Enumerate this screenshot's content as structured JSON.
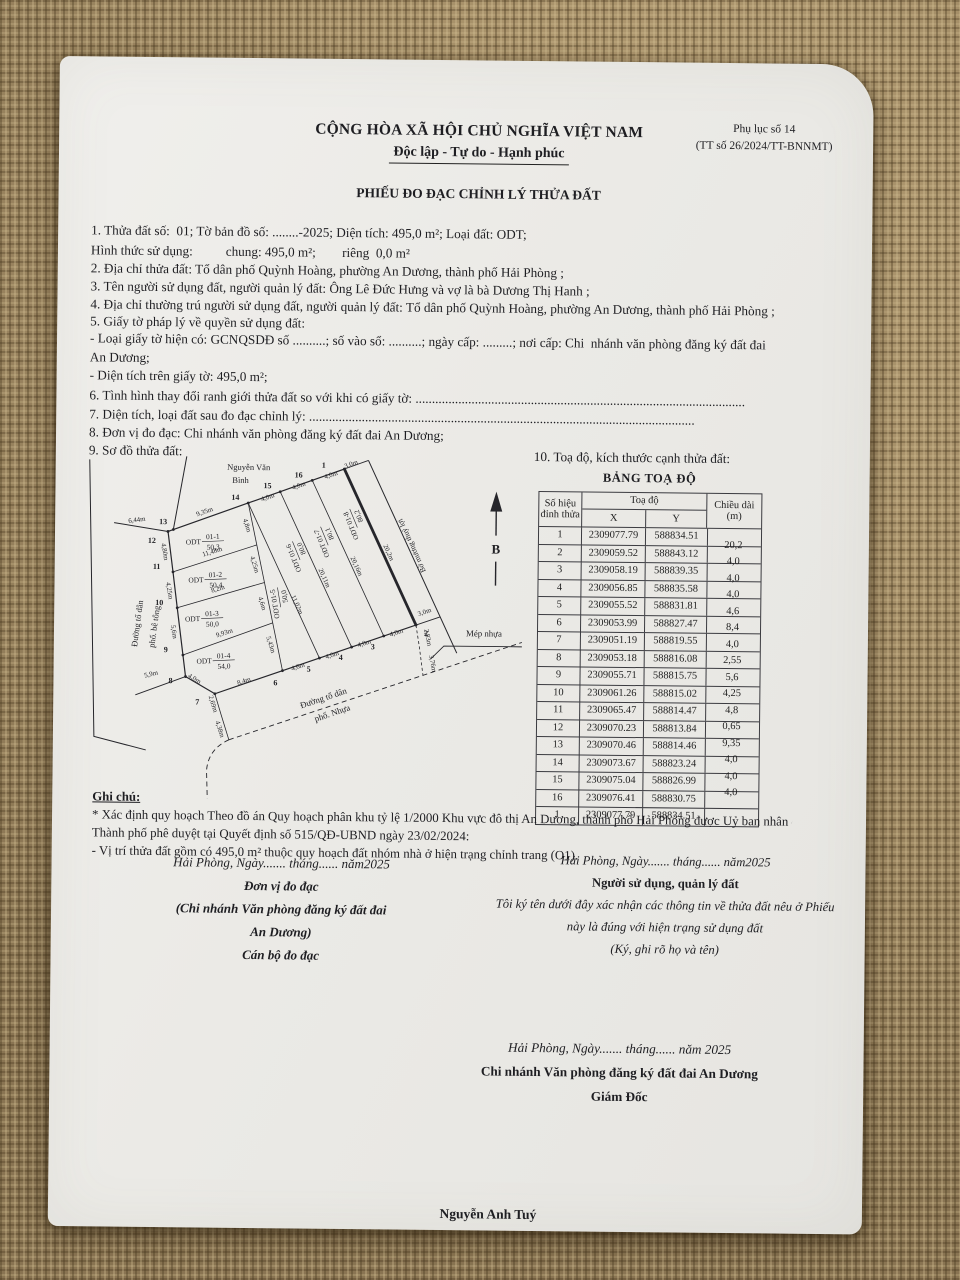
{
  "colors": {
    "fabric": "#a78e64",
    "paper": "#edece8",
    "ink": "#1e1e22"
  },
  "header": {
    "national_title": "CỘNG HÒA XÃ HỘI CHỦ NGHĨA VIỆT NAM",
    "motto": "Độc lập - Tự do - Hạnh phúc",
    "appendix1": "Phụ lục số 14",
    "appendix2": "(TT số 26/2024/TT-BNNMT)",
    "form_title": "PHIẾU ĐO ĐẠC CHỈNH LÝ THỬA ĐẤT"
  },
  "items": {
    "i1": "1. Thửa đất số:  01; Tờ bản đồ số: ........-2025; Diện tích: 495,0 m²; Loại đất: ODT;",
    "i1b": "Hình thức sử dụng:          chung: 495,0 m²;        riêng  0,0 m²",
    "i2": "2. Địa chỉ thửa đất: Tổ dân phố Quỳnh Hoàng, phường An Dương, thành phố Hải Phòng ;",
    "i3": "3. Tên người sử dụng đất, người quản lý đất: Ông Lê Đức Hưng và vợ là bà Dương Thị Hanh ;",
    "i4": "4. Địa chỉ thường trú người sử dụng đất, người quản lý đất: Tổ dân phố Quỳnh Hoàng, phường An Dương, thành phố Hải Phòng ;",
    "i5": "5. Giấy tờ pháp lý về quyền sử dụng đất:",
    "i5a": "- Loại giấy tờ hiện có: GCNQSDĐ số ..........; số vào sổ: ..........; ngày cấp: .........; nơi cấp: Chi  nhánh văn phòng đăng ký đất đai",
    "i5a2": "An Dương;",
    "i5b": "- Diện tích trên giấy tờ: 495,0 m²;",
    "i6": "6. Tình hình thay đổi ranh giới thửa đất so với khi có giấy tờ: ....................................................................................................",
    "i7": "7. Diện tích, loại đất sau đo đạc chỉnh lý: .....................................................................................................................",
    "i8": "8. Đơn vị đo đạc: Chi nhánh văn phòng đăng ký đất đai An Dương;",
    "i9": "9. Sơ đồ thửa đất:",
    "i10": "10. Toạ độ, kích thước cạnh thửa đất:"
  },
  "table": {
    "title": "BẢNG TOẠ ĐỘ",
    "col_vertex1": "Số hiệu",
    "col_vertex2": "đỉnh thửa",
    "col_coord": "Toạ độ",
    "col_x": "X",
    "col_y": "Y",
    "col_len1": "Chiều dài",
    "col_len2": "(m)",
    "rows": [
      {
        "v": "1",
        "x": "2309077.79",
        "y": "588834.51"
      },
      {
        "v": "2",
        "x": "2309059.52",
        "y": "588843.12"
      },
      {
        "v": "3",
        "x": "2309058.19",
        "y": "588839.35"
      },
      {
        "v": "4",
        "x": "2309056.85",
        "y": "588835.58"
      },
      {
        "v": "5",
        "x": "2309055.52",
        "y": "588831.81"
      },
      {
        "v": "6",
        "x": "2309053.99",
        "y": "588827.47"
      },
      {
        "v": "7",
        "x": "2309051.19",
        "y": "588819.55"
      },
      {
        "v": "8",
        "x": "2309053.18",
        "y": "588816.08"
      },
      {
        "v": "9",
        "x": "2309055.71",
        "y": "588815.75"
      },
      {
        "v": "10",
        "x": "2309061.26",
        "y": "588815.02"
      },
      {
        "v": "11",
        "x": "2309065.47",
        "y": "588814.47"
      },
      {
        "v": "12",
        "x": "2309070.23",
        "y": "588813.84"
      },
      {
        "v": "13",
        "x": "2309070.46",
        "y": "588814.46"
      },
      {
        "v": "14",
        "x": "2309073.67",
        "y": "588823.24"
      },
      {
        "v": "15",
        "x": "2309075.04",
        "y": "588826.99"
      },
      {
        "v": "16",
        "x": "2309076.41",
        "y": "588830.75"
      },
      {
        "v": "1",
        "x": "2309077.79",
        "y": "588834.51"
      }
    ],
    "lengths": [
      "20,2",
      "4,0",
      "4,0",
      "4,0",
      "4,6",
      "8,4",
      "4,0",
      "2,55",
      "5,6",
      "4,25",
      "4,8",
      "0,65",
      "9,35",
      "4,0",
      "4,0",
      "4,0"
    ]
  },
  "diagram": {
    "north_label": "B",
    "points": [
      [
        260.7,
        15
      ],
      [
        333.9,
        170.3
      ],
      [
        301.8,
        181.6
      ],
      [
        269.8,
        193
      ],
      [
        237.7,
        204.3
      ],
      [
        200.9,
        217.3
      ],
      [
        133.5,
        241.1
      ],
      [
        104,
        224.2
      ],
      [
        101.2,
        202.7
      ],
      [
        95,
        155.5
      ],
      [
        90.4,
        119.7
      ],
      [
        85,
        79.3
      ],
      [
        90.3,
        77.3
      ],
      [
        164.9,
        50
      ],
      [
        196.8,
        38.4
      ],
      [
        228.7,
        26.7
      ]
    ],
    "vertex_labels": [
      {
        "t": "1",
        "x": 240,
        "y": 14
      },
      {
        "t": "2",
        "x": 344,
        "y": 181
      },
      {
        "t": "3",
        "x": 291,
        "y": 195
      },
      {
        "t": "4",
        "x": 259,
        "y": 206
      },
      {
        "t": "5",
        "x": 227,
        "y": 218
      },
      {
        "t": "6",
        "x": 194,
        "y": 232
      },
      {
        "t": "7",
        "x": 116,
        "y": 252
      },
      {
        "t": "8",
        "x": 89,
        "y": 231
      },
      {
        "t": "9",
        "x": 84,
        "y": 200
      },
      {
        "t": "10",
        "x": 77,
        "y": 153
      },
      {
        "t": "11",
        "x": 74,
        "y": 117
      },
      {
        "t": "12",
        "x": 69,
        "y": 91
      },
      {
        "t": "13",
        "x": 80,
        "y": 72
      },
      {
        "t": "14",
        "x": 152,
        "y": 47
      },
      {
        "t": "15",
        "x": 184,
        "y": 35
      },
      {
        "t": "16",
        "x": 215,
        "y": 24
      }
    ],
    "edge_labels": [
      {
        "t": "9,35m",
        "x": 122,
        "y": 61,
        "r": -20
      },
      {
        "t": "4,0m",
        "x": 185,
        "y": 46,
        "r": -20
      },
      {
        "t": "4,0m",
        "x": 216,
        "y": 34,
        "r": -20
      },
      {
        "t": "4,0m",
        "x": 248,
        "y": 23,
        "r": -20
      },
      {
        "t": "3,0m",
        "x": 268,
        "y": 12,
        "r": -20
      },
      {
        "t": "6,44m",
        "x": 54,
        "y": 70,
        "r": -8
      },
      {
        "t": "4,80m",
        "x": 80,
        "y": 100,
        "r": 80
      },
      {
        "t": "4,25m",
        "x": 85,
        "y": 139,
        "r": 80
      },
      {
        "t": "5,6m",
        "x": 90,
        "y": 180,
        "r": 80
      },
      {
        "t": "5,9m",
        "x": 70,
        "y": 224,
        "r": -14
      },
      {
        "t": "4,0m",
        "x": 112,
        "y": 228,
        "r": 30
      },
      {
        "t": "2,69m",
        "x": 130,
        "y": 252,
        "r": 72
      },
      {
        "t": "4,38m",
        "x": 137,
        "y": 277,
        "r": 72
      },
      {
        "t": "8,4m",
        "x": 163,
        "y": 230,
        "r": -19
      },
      {
        "t": "4,6m",
        "x": 217,
        "y": 215,
        "r": -19
      },
      {
        "t": "4,0m",
        "x": 251,
        "y": 203,
        "r": -19
      },
      {
        "t": "4,0m",
        "x": 283,
        "y": 191,
        "r": -19
      },
      {
        "t": "4,0m",
        "x": 315,
        "y": 180,
        "r": -19
      },
      {
        "t": "3,0m",
        "x": 343,
        "y": 159,
        "r": -20
      },
      {
        "t": "2,83m",
        "x": 344,
        "y": 183,
        "r": 78
      },
      {
        "t": "3,76m",
        "x": 349,
        "y": 209,
        "r": 78
      },
      {
        "t": "20,2m",
        "x": 304,
        "y": 99,
        "r": 65
      },
      {
        "t": "20,16m",
        "x": 272,
        "y": 113,
        "r": 65
      },
      {
        "t": "20,11m",
        "x": 240,
        "y": 125,
        "r": 65
      },
      {
        "t": "11,02m",
        "x": 213,
        "y": 152,
        "r": 65
      },
      {
        "t": "4,8m",
        "x": 162,
        "y": 73,
        "r": 72
      },
      {
        "t": "4,25m",
        "x": 170,
        "y": 112,
        "r": 72
      },
      {
        "t": "4,6m",
        "x": 178,
        "y": 151,
        "r": 72
      },
      {
        "t": "5,43m",
        "x": 187,
        "y": 192,
        "r": 72
      },
      {
        "t": "11,48m",
        "x": 130,
        "y": 101,
        "r": -18
      },
      {
        "t": "8,2m",
        "x": 136,
        "y": 138,
        "r": -18
      },
      {
        "t": "9,93m",
        "x": 143,
        "y": 182,
        "r": -18
      }
    ],
    "parcels": [
      {
        "code": "01-1",
        "area": "50,3",
        "x": 118,
        "y": 88
      },
      {
        "code": "01-2",
        "area": "50,4",
        "x": 121,
        "y": 126
      },
      {
        "code": "01-3",
        "area": "50,0",
        "x": 118,
        "y": 165
      },
      {
        "code": "01-4",
        "area": "54,0",
        "x": 130,
        "y": 207
      }
    ],
    "strips": [
      {
        "code": "ODT 01-5",
        "area": "50,0",
        "x": 197,
        "y": 150,
        "r": -100
      },
      {
        "code": "ODT 01-6",
        "area": "80,0",
        "x": 215,
        "y": 103,
        "r": -113
      },
      {
        "code": "ODT 01-7",
        "area": "80,1",
        "x": 243,
        "y": 88,
        "r": -113
      },
      {
        "code": "ODT 01-8",
        "area": "80,2",
        "x": 272,
        "y": 70,
        "r": -113
      }
    ],
    "texts": [
      {
        "t": "Nguyễn Văn",
        "x": 165,
        "y": 17,
        "r": 0,
        "s": 8.5
      },
      {
        "t": "Bình",
        "x": 157,
        "y": 30,
        "r": 0,
        "s": 8.5
      },
      {
        "t": "Bờ mương thuỷ lợi",
        "x": 331,
        "y": 90,
        "r": -115,
        "s": 7.6
      },
      {
        "t": "Mép nhựa",
        "x": 402,
        "y": 181,
        "r": 0,
        "s": 8.8
      },
      {
        "t": "Đường tổ dân",
        "x": 243,
        "y": 247,
        "r": -19,
        "s": 8.8
      },
      {
        "t": "phố. Nhựa",
        "x": 252,
        "y": 262,
        "r": -19,
        "s": 8.8
      },
      {
        "t": "Đường tổ dân",
        "x": 58,
        "y": 172,
        "r": -83,
        "s": 8.5
      },
      {
        "t": "phố. bê tông",
        "x": 75,
        "y": 175,
        "r": -83,
        "s": 8.5
      }
    ]
  },
  "notes": {
    "label": "Ghi chú:",
    "n1": "* Xác định quy hoạch Theo đồ án Quy hoạch phân khu tỷ lệ 1/2000 Khu vực đô thị An Dương, thành phố Hải Phòng được Uỷ ban nhân dân",
    "n2": "Thành phố phê duyệt tại Quyết định số 515/QĐ-UBND ngày 23/02/2024:",
    "n3": "- Vị trí thửa đất gồm có 495,0 m² thuộc quy hoạch đất nhóm nhà ở hiện trạng chỉnh trang (O1)."
  },
  "sign": {
    "left_date": "Hải Phòng, Ngày....... tháng...... năm2025",
    "left_role": "Đơn vị đo đạc",
    "left_org1": "(Chi nhánh Văn phòng đăng ký đất đai",
    "left_org2": "An Dương)",
    "left_person": "Cán bộ đo đạc",
    "right_date": "Hải Phòng, Ngày....... tháng...... năm2025",
    "right_role": "Người sử dụng, quản lý đất",
    "right_note1": "Tôi ký tên dưới đây xác nhận các thông tin về thửa đất nêu ở Phiếu",
    "right_note2": "này là đúng với hiện trạng sử dụng đất",
    "right_sign": "(Ký, ghi rõ họ và tên)"
  },
  "footer": {
    "date": "Hải Phòng, Ngày....... tháng...... năm 2025",
    "org": "Chi nhánh Văn phòng đăng ký đất đai An Dương",
    "role": "Giám Đốc",
    "name": "Nguyễn Anh Tuý"
  }
}
